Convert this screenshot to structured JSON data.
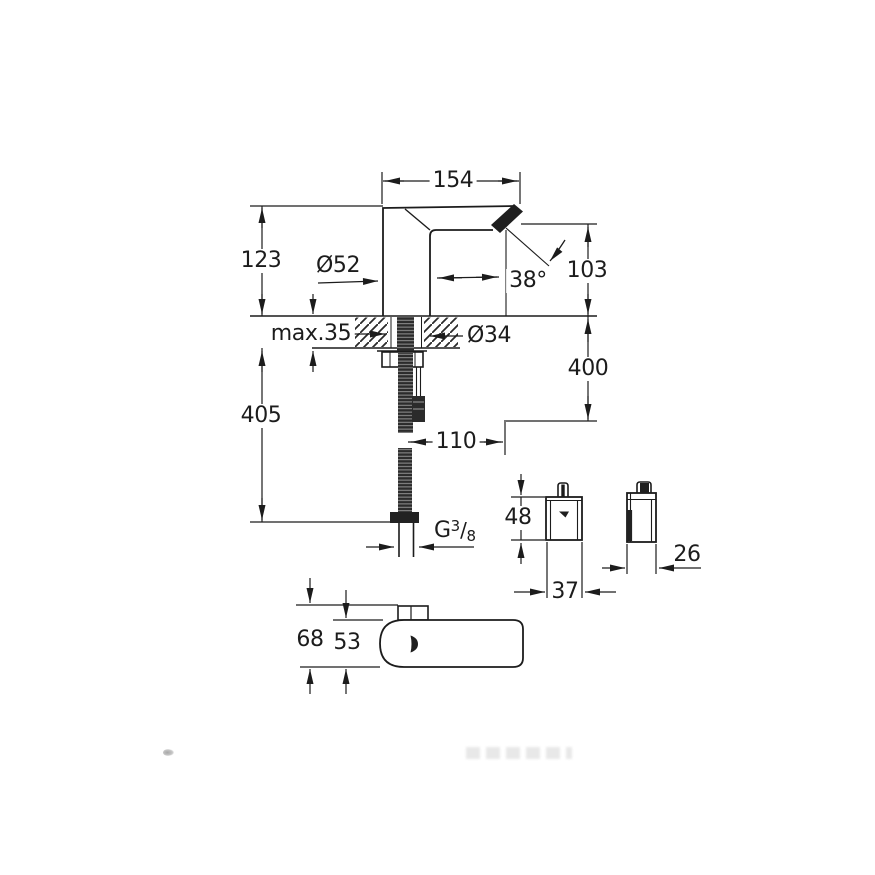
{
  "front_view": {
    "spout_width": "154",
    "height_above_deck": "123",
    "body_diameter": "Ø52",
    "spray_angle": "38°",
    "outlet_to_deck": "103",
    "deck_thickness": "max.35",
    "hole_diameter": "Ø34",
    "supply_drop": "400",
    "hose_length": "405",
    "supply_offset": "110",
    "thread": {
      "prefix": "G",
      "numerator": "3",
      "slash": "/",
      "denominator": "8"
    }
  },
  "power_unit": {
    "height": "48",
    "width": "37",
    "depth": "26"
  },
  "top_view": {
    "depth_with_spout": "68",
    "body_depth": "53"
  }
}
